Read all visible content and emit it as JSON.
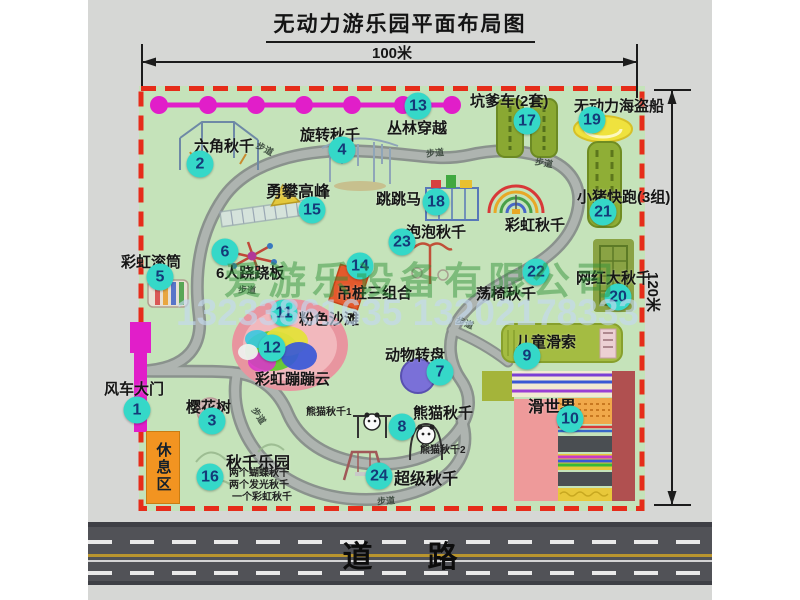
{
  "title": "无动力游乐园平面布局图",
  "dimensions": {
    "width": "100米",
    "height": "120米"
  },
  "watermark": {
    "company": "爱游乐设备有限公司",
    "phone": "13233861635 13202178333"
  },
  "road_label": "道路",
  "rest_area_label": "休息区",
  "walkway_label": "步道",
  "walkway_positions": [
    {
      "x": 256,
      "y": 142,
      "r": 28
    },
    {
      "x": 426,
      "y": 146,
      "r": -6
    },
    {
      "x": 535,
      "y": 156,
      "r": 10
    },
    {
      "x": 238,
      "y": 283,
      "r": 2
    },
    {
      "x": 250,
      "y": 409,
      "r": 56
    },
    {
      "x": 456,
      "y": 316,
      "r": 22
    },
    {
      "x": 377,
      "y": 494,
      "r": -4
    }
  ],
  "colors": {
    "map_green": "#c5e3ba",
    "boundary_red": "#e62c1a",
    "marker_cyan": "#35d8c8",
    "zipline_magenta": "#e11ec9",
    "gate_magenta": "#e11ec9",
    "rest_orange": "#f29421",
    "road_gray": "#515257",
    "watermark_green": "rgba(45,145,55,0.48)",
    "watermark_blue": "rgba(195,216,240,0.65)"
  },
  "attractions": [
    {
      "id": "windmill-gate",
      "num": "1",
      "label": "风车大门",
      "marker": [
        137,
        410
      ],
      "label_pos": [
        104,
        378
      ],
      "size": 15
    },
    {
      "id": "hexagon-swing",
      "num": "2",
      "label": "六角秋千",
      "marker": [
        200,
        164
      ],
      "label_pos": [
        194,
        135
      ],
      "size": 15
    },
    {
      "id": "cherry-tree",
      "num": "3",
      "label": "樱花树",
      "marker": [
        212,
        421
      ],
      "label_pos": [
        186,
        396
      ],
      "size": 15
    },
    {
      "id": "rotating-swing",
      "num": "4",
      "label": "旋转秋千",
      "marker": [
        342,
        150
      ],
      "label_pos": [
        300,
        124
      ],
      "size": 15
    },
    {
      "id": "rainbow-roller",
      "num": "5",
      "label": "彩虹滚筒",
      "marker": [
        160,
        277
      ],
      "label_pos": [
        121,
        251
      ],
      "size": 15
    },
    {
      "id": "six-seesaw",
      "num": "6",
      "label": "6人跷跷板",
      "marker": [
        225,
        252
      ],
      "label_pos": [
        216,
        262
      ],
      "size": 15
    },
    {
      "id": "animal-carousel",
      "num": "7",
      "label": "动物转盘",
      "marker": [
        440,
        372
      ],
      "label_pos": [
        385,
        344
      ],
      "size": 15
    },
    {
      "id": "panda-swing",
      "num": "8",
      "label": "熊猫秋千",
      "marker": [
        402,
        427
      ],
      "label_pos": [
        413,
        402
      ],
      "size": 15
    },
    {
      "id": "kids-zipline",
      "num": "9",
      "label": "儿童滑索",
      "marker": [
        527,
        356
      ],
      "label_pos": [
        516,
        331
      ],
      "size": 15
    },
    {
      "id": "slide-world",
      "num": "10",
      "label": "滑世界",
      "marker": [
        570,
        419
      ],
      "label_pos": [
        528,
        393
      ],
      "size": 16
    },
    {
      "id": "pink-beach",
      "num": "11",
      "label": "粉色沙滩",
      "marker": [
        284,
        313
      ],
      "label_pos": [
        299,
        308
      ],
      "size": 15
    },
    {
      "id": "rainbow-cloud",
      "num": "12",
      "label": "彩虹蹦蹦云",
      "marker": [
        272,
        348
      ],
      "label_pos": [
        255,
        368
      ],
      "size": 15
    },
    {
      "id": "jungle-crossing",
      "num": "13",
      "label": "丛林穿越",
      "marker": [
        418,
        106
      ],
      "label_pos": [
        387,
        117
      ],
      "size": 15
    },
    {
      "id": "hanging-piles",
      "num": "14",
      "label": "吊桩三组合",
      "marker": [
        360,
        266
      ],
      "label_pos": [
        337,
        282
      ],
      "size": 15
    },
    {
      "id": "climbing-peak",
      "num": "15",
      "label": "勇攀高峰",
      "marker": [
        312,
        210
      ],
      "label_pos": [
        266,
        178
      ],
      "size": 16
    },
    {
      "id": "swing-park",
      "num": "16",
      "label": "秋千乐园",
      "marker": [
        210,
        477
      ],
      "label_pos": [
        226,
        449
      ],
      "size": 16
    },
    {
      "id": "kengdie-car",
      "num": "17",
      "label": "坑爹车(2套)",
      "marker": [
        527,
        121
      ],
      "label_pos": [
        470,
        90
      ],
      "size": 15
    },
    {
      "id": "jumping-horse",
      "num": "18",
      "label": "跳跳马",
      "marker": [
        436,
        202
      ],
      "label_pos": [
        376,
        188
      ],
      "size": 15
    },
    {
      "id": "pirate-ship",
      "num": "19",
      "label": "无动力海盗船",
      "marker": [
        592,
        120
      ],
      "label_pos": [
        574,
        95
      ],
      "size": 15
    },
    {
      "id": "big-net-swing",
      "num": "20",
      "label": "网红大秋千",
      "marker": [
        618,
        297
      ],
      "label_pos": [
        576,
        267
      ],
      "size": 15
    },
    {
      "id": "pig-run",
      "num": "21",
      "label": "小猪快跑(3组)",
      "marker": [
        603,
        212
      ],
      "label_pos": [
        577,
        186
      ],
      "size": 15
    },
    {
      "id": "rocking-chair-swing",
      "num": "22",
      "label": "荡椅秋千",
      "marker": [
        536,
        272
      ],
      "label_pos": [
        476,
        283
      ],
      "size": 15
    },
    {
      "id": "bubble-swing",
      "num": "23",
      "label": "泡泡秋千",
      "marker": [
        402,
        242
      ],
      "label_pos": [
        406,
        221
      ],
      "size": 15
    },
    {
      "id": "super-swing",
      "num": "24",
      "label": "超级秋千",
      "marker": [
        379,
        476
      ],
      "label_pos": [
        394,
        465
      ],
      "size": 16
    },
    {
      "id": "rainbow-swing",
      "num": "",
      "label": "彩虹秋千",
      "marker": null,
      "label_pos": [
        505,
        214
      ],
      "size": 15
    }
  ],
  "sub_labels": [
    {
      "id": "panda-swing-1",
      "text": "熊猫秋千1",
      "pos": [
        306,
        403
      ]
    },
    {
      "id": "panda-swing-2",
      "text": "熊猫秋千2",
      "pos": [
        420,
        441
      ]
    },
    {
      "id": "swing-park-line-1",
      "text": "两个蝴蝶秋千",
      "pos": [
        229,
        464
      ]
    },
    {
      "id": "swing-park-line-2",
      "text": "两个发光秋千",
      "pos": [
        229,
        476
      ]
    },
    {
      "id": "swing-park-line-3",
      "text": "一个彩虹秋千",
      "pos": [
        232,
        488
      ]
    }
  ]
}
